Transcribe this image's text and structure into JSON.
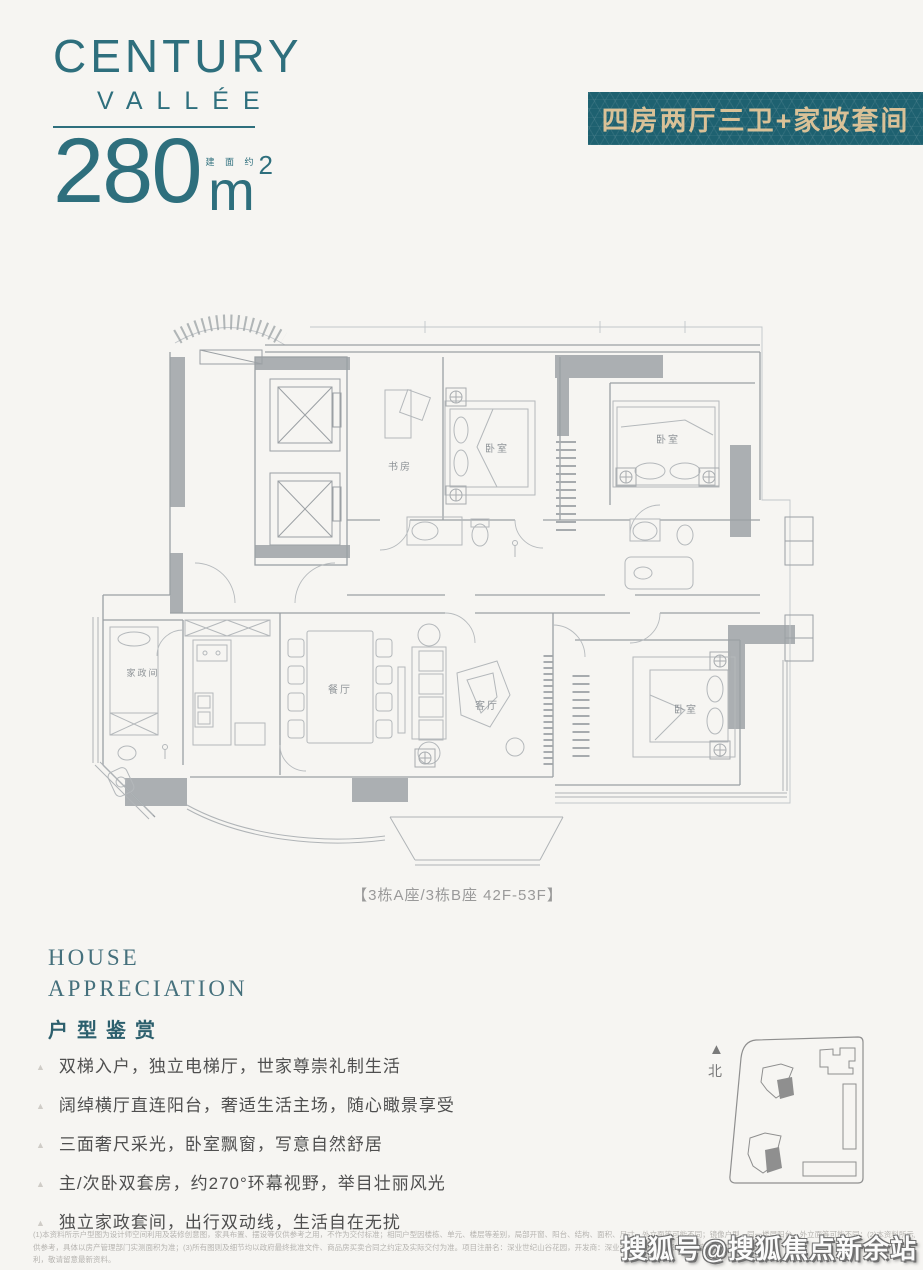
{
  "colors": {
    "teal": "#2e6f7d",
    "banner_bg": "#1e6170",
    "banner_text": "#d9c197",
    "plan_line": "#9ba0a4",
    "plan_fill": "#abafb2"
  },
  "logo": {
    "line1": "CENTURY",
    "line2": "VALLÉE"
  },
  "area": {
    "value": "280",
    "approx": "建 面 约",
    "unit": "m",
    "sup": "2"
  },
  "banner": {
    "label": "四房两厅三卫+家政套间"
  },
  "plan": {
    "caption": "【3栋A座/3栋B座 42F-53F】",
    "rooms": {
      "study": "书房",
      "bedroom": "卧室",
      "housekeeping": "家政间",
      "dining": "餐厅",
      "living": "客厅"
    }
  },
  "appreciation": {
    "en1": "HOUSE",
    "en2": "APPRECIATION",
    "zh": "户型鉴赏",
    "bullets": [
      "双梯入户，独立电梯厅，世家尊崇礼制生活",
      "阔绰横厅直连阳台，奢适生活主场，随心瞰景享受",
      "三面奢尺采光，卧室飘窗，写意自然舒居",
      "主/次卧双套房，约270°环幕视野，举目壮丽风光",
      "独立家政套间，出行双动线，生活自在无扰"
    ]
  },
  "siteplan": {
    "north": "北"
  },
  "disclaimer": {
    "line1": "(1)本资料所示户型图为设计师空间利用及装修创意图，家具布置、摆设等仅供参考之用，不作为交付标准；相同户型因楼栋、单元、楼层等差别，局部开窗、阳台、结构、面积、尺寸、外立面等可能不同；镜像户型，同一楼层阳台、外立面等可能不同；(2)本资料所示户型面积仅",
    "line2": "供参考，具体以房产管理部门实测面积为准；(3)所有图则及细节均以政府最终批准文件、商品房买卖合同之约定及实际交付为准。项目注册名：深业世纪山谷花园，开发商：深业沙河世纪山谷(深圳)投资有限公司，本资料版",
    "line3": "利，敬请留意最新资料。"
  },
  "watermark": "搜狐号@搜狐焦点新余站"
}
